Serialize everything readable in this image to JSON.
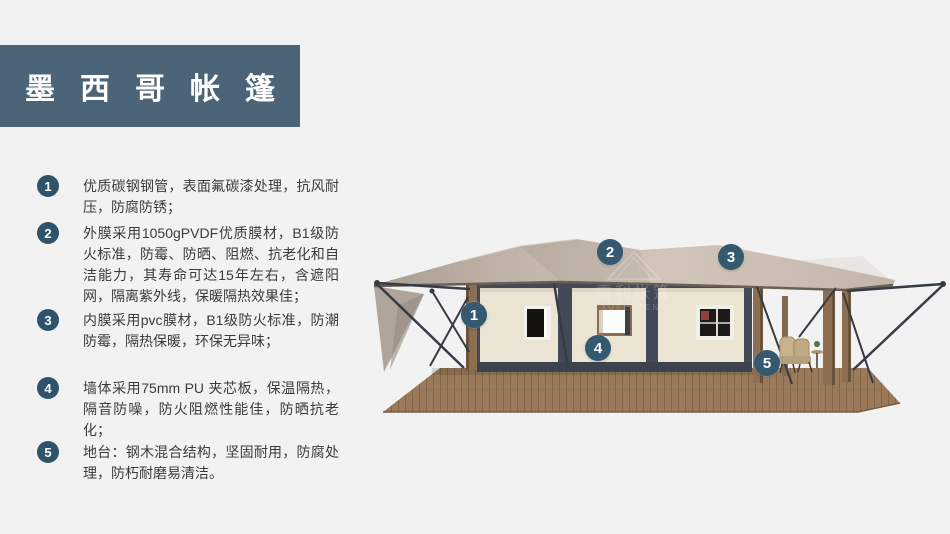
{
  "title": {
    "text": "墨西哥帐篷"
  },
  "features": [
    {
      "num": "1",
      "text": "优质碳钢钢管，表面氟碳漆处理，抗风耐压，防腐防锈；"
    },
    {
      "num": "2",
      "text": "外膜采用1050gPVDF优质膜材，B1级防火标准，防霉、防晒、阻燃、抗老化和自洁能力，其寿命可达15年左右，含遮阳网，隔离紫外线，保暖隔热效果佳；"
    },
    {
      "num": "3",
      "text": "内膜采用pvc膜材，B1级防火标准，防潮防霉，隔热保暖，环保无异味；"
    },
    {
      "num": "4",
      "text": "墙体采用75mm PU 夹芯板，保温隔热，隔音防噪，防火阻燃性能佳，防晒抗老化；"
    },
    {
      "num": "5",
      "text": "地台：钢木混合结构，坚固耐用，防腐处理，防朽耐磨易清洁。"
    }
  ],
  "figure": {
    "callouts": [
      "1",
      "2",
      "3",
      "4",
      "5"
    ],
    "watermark": {
      "cn": "雪利帐篷",
      "en": "XUELI TENT"
    }
  },
  "theme": {
    "background": "#f2f2f2",
    "title_bg": "#4c6477",
    "badge": "#2f536a",
    "callout_badge": "#35596f",
    "text": "#3b3b3b",
    "roof": "#c6b9ae",
    "wall": "#ece4d2",
    "frame": "#434956",
    "wood": "#8d6e50",
    "deck": "#9b7a5b",
    "steel": "#363c45"
  }
}
